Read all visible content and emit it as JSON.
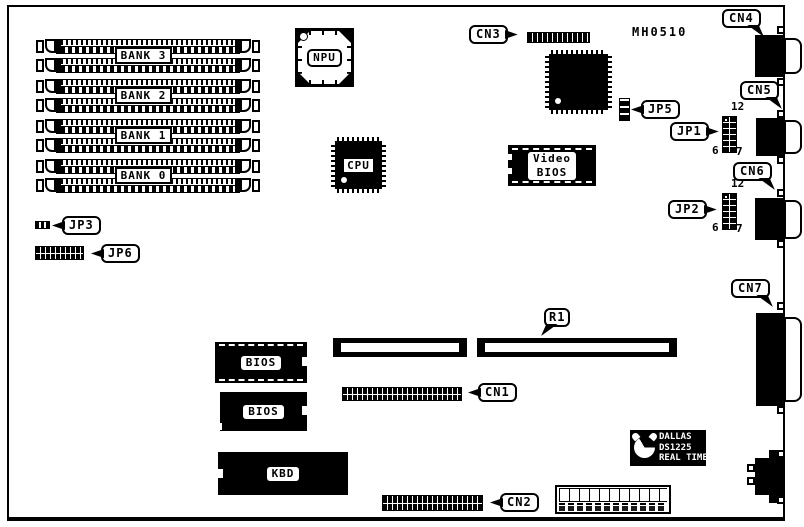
{
  "diagram": {
    "part_number": "MH0510"
  },
  "memory_banks": [
    {
      "label": "BANK 3"
    },
    {
      "label": "BANK 2"
    },
    {
      "label": "BANK 1"
    },
    {
      "label": "BANK 0"
    }
  ],
  "chips": {
    "npu": "NPU",
    "cpu": "CPU",
    "video_bios_line1": "Video",
    "video_bios_line2": "BIOS",
    "bios_1": "BIOS",
    "bios_2": "BIOS",
    "keyboard_controller": "KBD",
    "rtc_line1": "DALLAS",
    "rtc_line2": "DS1225",
    "rtc_line3": "REAL TIME"
  },
  "connectors": {
    "cn1": "CN1",
    "cn2": "CN2",
    "cn3": "CN3",
    "cn4": "CN4",
    "cn5": "CN5",
    "cn6": "CN6",
    "cn7": "CN7"
  },
  "jumpers": {
    "jp1": "JP1",
    "jp2": "JP2",
    "jp3": "JP3",
    "jp5": "JP5",
    "jp6": "JP6"
  },
  "pin_labels": {
    "jp1": {
      "top": "12",
      "bottom_left": "6",
      "bottom_right": "7"
    },
    "jp2": {
      "top": "12",
      "bottom_left": "6",
      "bottom_right": "7"
    }
  },
  "resistor": {
    "r1": "R1"
  },
  "colors": {
    "ink": "#000000",
    "paper": "#ffffff"
  }
}
